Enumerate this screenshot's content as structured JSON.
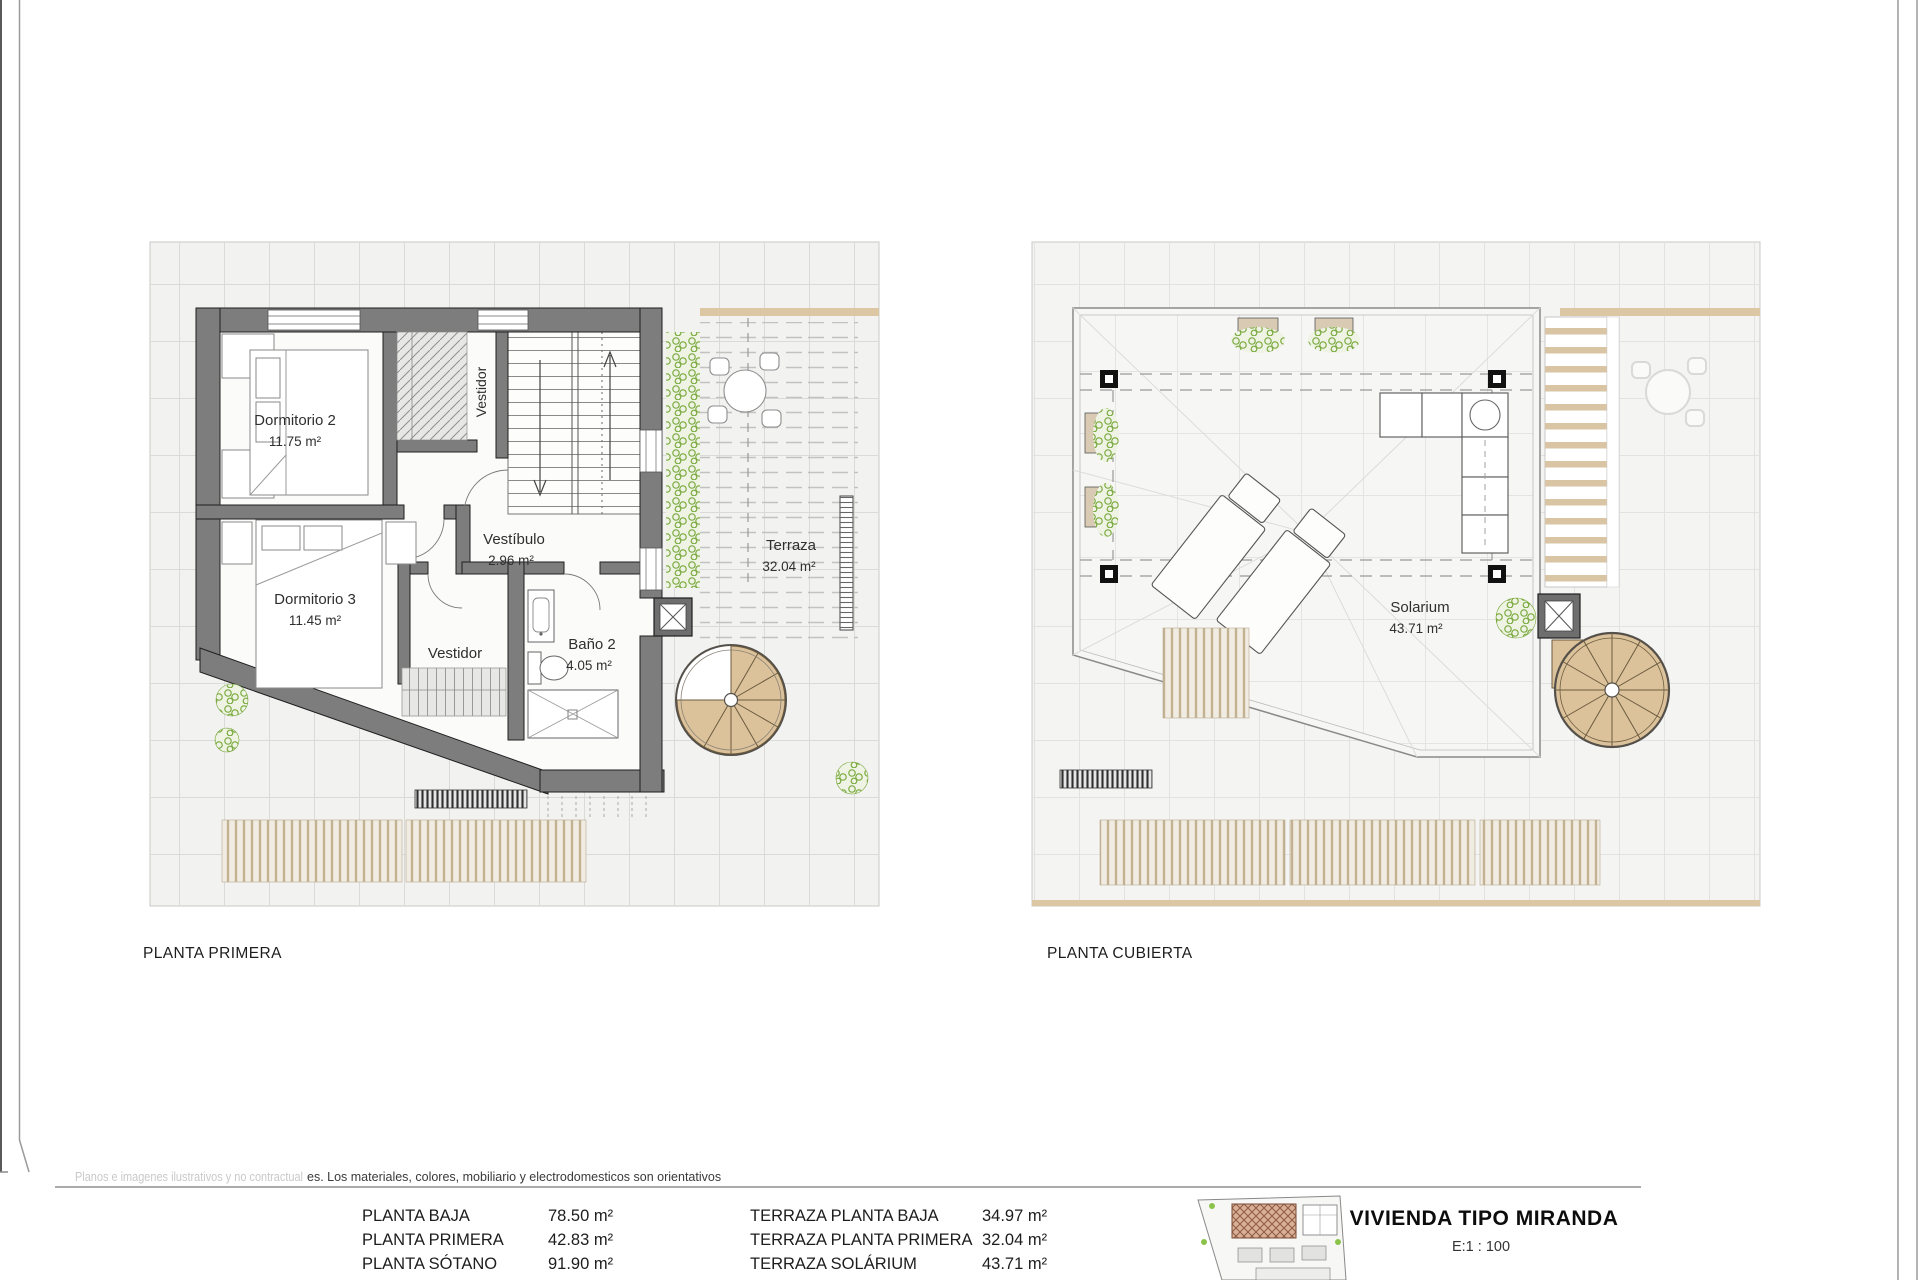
{
  "page": {
    "plan1_title": "PLANTA PRIMERA",
    "plan2_title": "PLANTA CUBIERTA",
    "disclaimer_faded": "Planos e imagenes ilustrativos y no contractual",
    "disclaimer_visible": "es. Los materiales, colores, mobiliario y electrodomesticos son orientativos",
    "project_title": "VIVIENDA TIPO MIRANDA",
    "scale_label": "E:1 : 100"
  },
  "plan1": {
    "rooms": {
      "dormitorio2": {
        "label": "Dormitorio 2",
        "area": "11.75 m²"
      },
      "dormitorio3": {
        "label": "Dormitorio 3",
        "area": "11.45 m²"
      },
      "vestibulo": {
        "label": "Vestíbulo",
        "area": "2.96 m²"
      },
      "vestidor_top": {
        "label": "Vestidor"
      },
      "vestidor_bottom": {
        "label": "Vestidor"
      },
      "bano2": {
        "label": "Baño 2",
        "area": "4.05 m²"
      },
      "terraza": {
        "label": "Terraza",
        "area": "32.04 m²"
      }
    }
  },
  "plan2": {
    "rooms": {
      "solarium": {
        "label": "Solarium",
        "area": "43.71 m²"
      }
    }
  },
  "areas_table": {
    "left": [
      {
        "label": "PLANTA BAJA",
        "value": "78.50 m²"
      },
      {
        "label": "PLANTA PRIMERA",
        "value": "42.83 m²"
      },
      {
        "label": "PLANTA SÓTANO",
        "value": "91.90 m²"
      }
    ],
    "right": [
      {
        "label": "TERRAZA PLANTA BAJA",
        "value": "34.97 m²"
      },
      {
        "label": "TERRAZA PLANTA PRIMERA",
        "value": "32.04 m²"
      },
      {
        "label": "TERRAZA SOLÁRIUM",
        "value": "43.71 m²"
      }
    ]
  },
  "colors": {
    "wall": "#7d7d7d",
    "wood": "#dcc29a",
    "plant": "#7aa93e",
    "tile_bg": "#f2f2f1"
  }
}
